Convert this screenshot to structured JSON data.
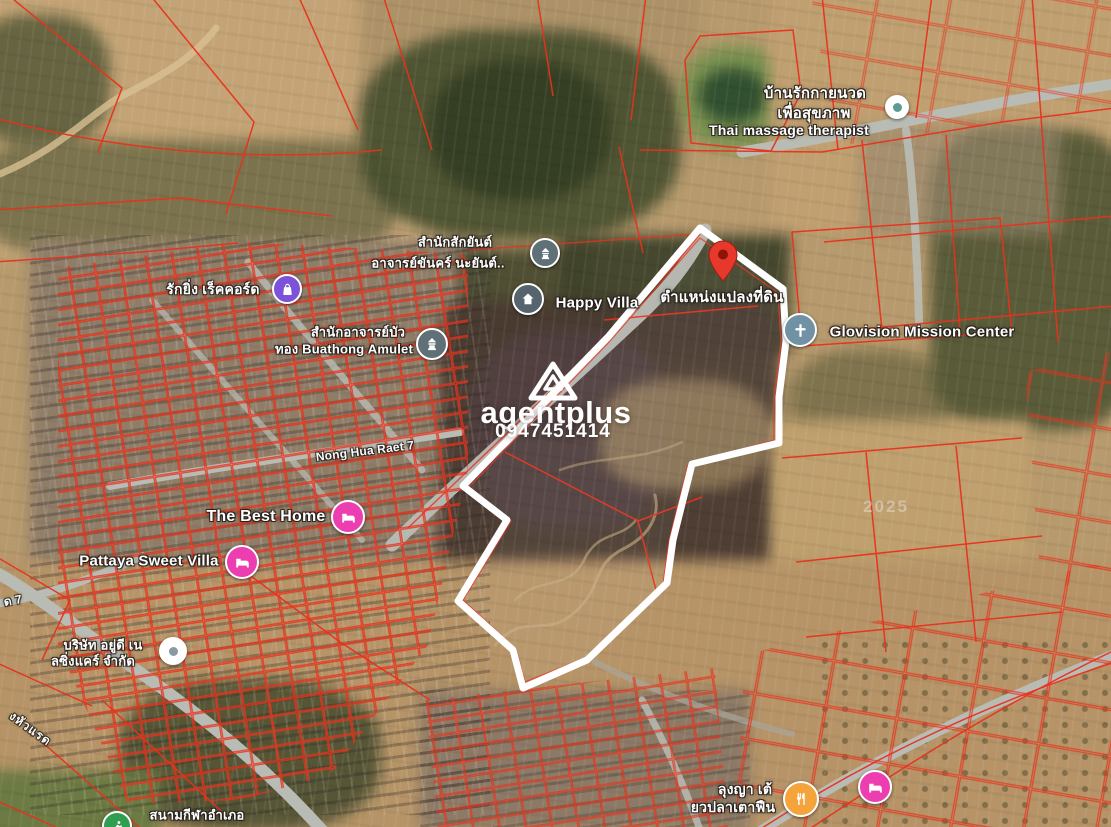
{
  "colors": {
    "parcel_line": "#e8321c",
    "plot_outline": "#ffffff",
    "pin": "#e6392b",
    "road": "#b9bcb5"
  },
  "plot": {
    "pin_label": "ตำแหน่งแปลงที่ดิน"
  },
  "watermark": {
    "brand": "agentplus",
    "phone": "0947451414"
  },
  "imagery_year_label": "2025",
  "markers": [
    {
      "id": "sak-yant-office",
      "lines": [
        "สำนักสักยันต์",
        "อาจารย์ขันคร์ นะยันต์.."
      ],
      "icon": "shrine-icon",
      "icon_color": "#5f7077"
    },
    {
      "id": "happy-villa",
      "label": "Happy Villa",
      "icon": "villa-house-icon",
      "icon_color": "#56646d"
    },
    {
      "id": "thai-massage",
      "lines": [
        "บ้านรักกายนวด",
        "เพื่อสุขภาพ",
        "Thai massage therapist"
      ],
      "icon": "place-dot-icon",
      "icon_color": "#5e9a93"
    },
    {
      "id": "glovision-mission-center",
      "label": "Glovision Mission Center",
      "icon": "church-cross-icon",
      "icon_color": "#7191a5"
    },
    {
      "id": "rak-ying-record",
      "label": "รักยิ่ง เร็คคอร์ด",
      "icon": "shopping-bag-icon",
      "icon_color": "#7c52d9"
    },
    {
      "id": "buathong-amulet",
      "lines": [
        "สำนักอาจารย์บัว",
        "ทอง Buathong Amulet"
      ],
      "icon": "shrine-icon",
      "icon_color": "#5f7077"
    },
    {
      "id": "the-best-home",
      "label": "The Best Home",
      "icon": "lodging-bed-icon",
      "icon_color": "#ec3eb0"
    },
    {
      "id": "pattaya-sweet-villa",
      "label": "Pattaya Sweet Villa",
      "icon": "lodging-bed-icon",
      "icon_color": "#ec3eb0"
    },
    {
      "id": "yudee-nursing-care",
      "lines": [
        "บริษัท อยู่ดี เน",
        "ลซิ่งแคร์ จำกัด"
      ],
      "icon": "place-dot-icon",
      "icon_color": "#8a9aa5"
    },
    {
      "id": "district-sports-field",
      "label": "สนามกีฬาอำเภอ",
      "icon": "sports-icon",
      "icon_color": "#2f9e51"
    },
    {
      "id": "lung-ya-fish-noodle",
      "lines": [
        "ลุงญา เต้",
        "ยวปลาเตาฟืน"
      ],
      "icon": "restaurant-icon",
      "icon_color": "#f5a43b"
    },
    {
      "id": "lodging-east",
      "label": "",
      "icon": "lodging-bed-icon",
      "icon_color": "#ec3eb0"
    }
  ],
  "road_labels": [
    {
      "id": "nong-hua-raet-7",
      "text": "Nong Hua Raet 7"
    },
    {
      "id": "road-d-7",
      "text": "ด 7"
    },
    {
      "id": "nong-hua-raet",
      "text": "งหัวแรด"
    }
  ]
}
